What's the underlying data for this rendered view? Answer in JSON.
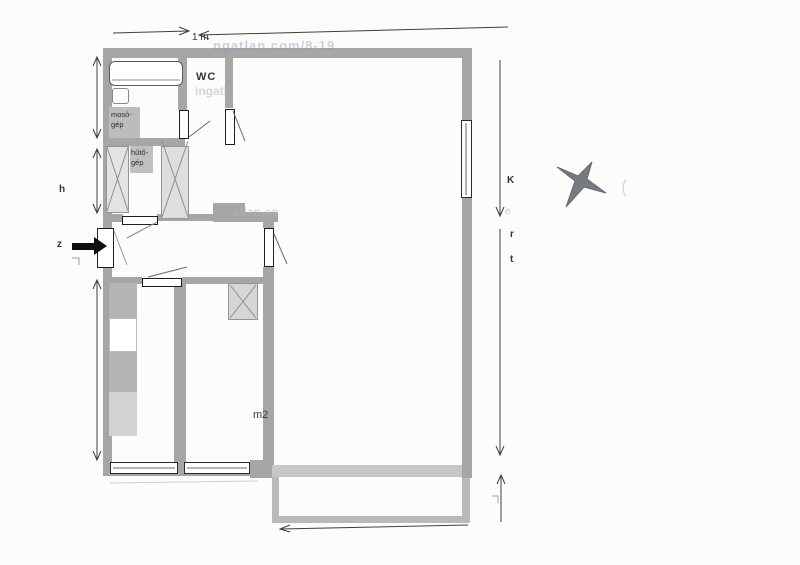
{
  "floorplan": {
    "scale_label": "1 m",
    "wc": "WC",
    "washer": {
      "l1": "mosó-",
      "l2": "gép"
    },
    "fridge": {
      "l1": "hűtő-",
      "l2": "gép"
    },
    "area": "m2",
    "dims": {
      "h": "h",
      "z": "z",
      "k": "K",
      "e": "e",
      "r": "r",
      "t": "t"
    },
    "watermarks": {
      "top": "ngatlan.com/8-19",
      "wc": "ingatl",
      "hall": "atlan.co"
    },
    "icons": {
      "north": "compass-star-icon",
      "entrance": "entrance-arrow-icon"
    },
    "colors": {
      "wall": "#a6a6a6",
      "furniture": "#b9b9b9",
      "cabinet": "#e0e0e0",
      "star": "#757b81",
      "line": "#3f3f3f",
      "paper": "#fcfcfb"
    }
  }
}
